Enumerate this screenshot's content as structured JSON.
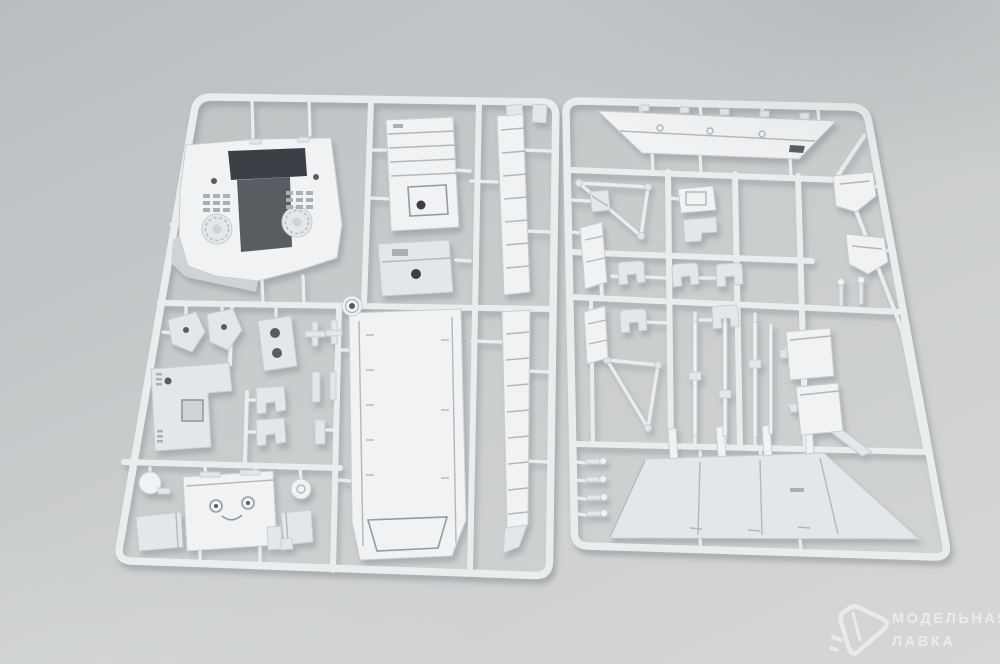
{
  "watermark": {
    "logo_icon": "paper-plane-icon",
    "line1": "МОДЕЛЬНАЯ",
    "line2": "ЛАВКА"
  },
  "colors": {
    "bg_top": "#b9bdc0",
    "bg_mid": "#c9cccd",
    "bg_bottom": "#d6d7d7",
    "plastic": "#eaedee",
    "plastic_bright": "#f0f2f3",
    "plastic_mid": "#e3e7e9",
    "plastic_shade": "#ced3d6",
    "detail_line": "#b2b8bc",
    "dark_opening": "#3c4046",
    "dark_soft": "#585d62",
    "watermark": "#eef0f1"
  }
}
